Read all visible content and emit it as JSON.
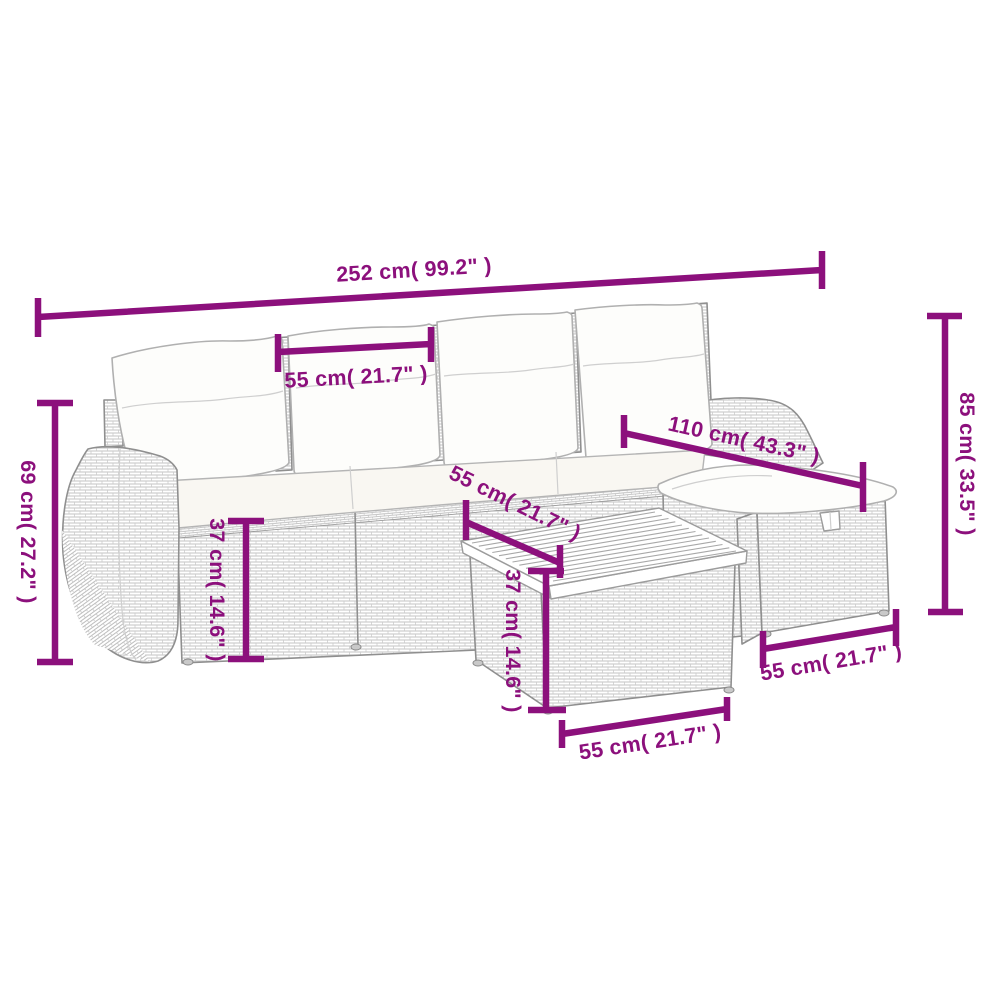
{
  "diagram": {
    "type": "product-dimension-diagram",
    "subject": "rattan-garden-sofa-set-with-table-and-stool",
    "background": "#ffffff",
    "colors": {
      "dimension": "#8C107C",
      "furniture_outline": "#8f8f8f",
      "weave_texture": "#c3c3c3",
      "cushion_fill": "#fdfdfb"
    },
    "measurements": [
      {
        "id": "overall-width",
        "label": "252 cm( 99.2\" )"
      },
      {
        "id": "seat-width",
        "label": "55 cm( 21.7\" )"
      },
      {
        "id": "backrest-height",
        "label": "69 cm( 27.2\" )"
      },
      {
        "id": "seat-height",
        "label": "37 cm( 14.6\" )"
      },
      {
        "id": "seat-depth",
        "label": "55 cm( 21.7\" )"
      },
      {
        "id": "chaise-length",
        "label": "110 cm( 43.3\" )"
      },
      {
        "id": "table-height",
        "label": "37 cm( 14.6\" )"
      },
      {
        "id": "table-width",
        "label": "55 cm( 21.7\" )"
      },
      {
        "id": "stool-width",
        "label": "55 cm( 21.7\" )"
      },
      {
        "id": "overall-height",
        "label": "85 cm( 33.5\" )"
      }
    ]
  }
}
